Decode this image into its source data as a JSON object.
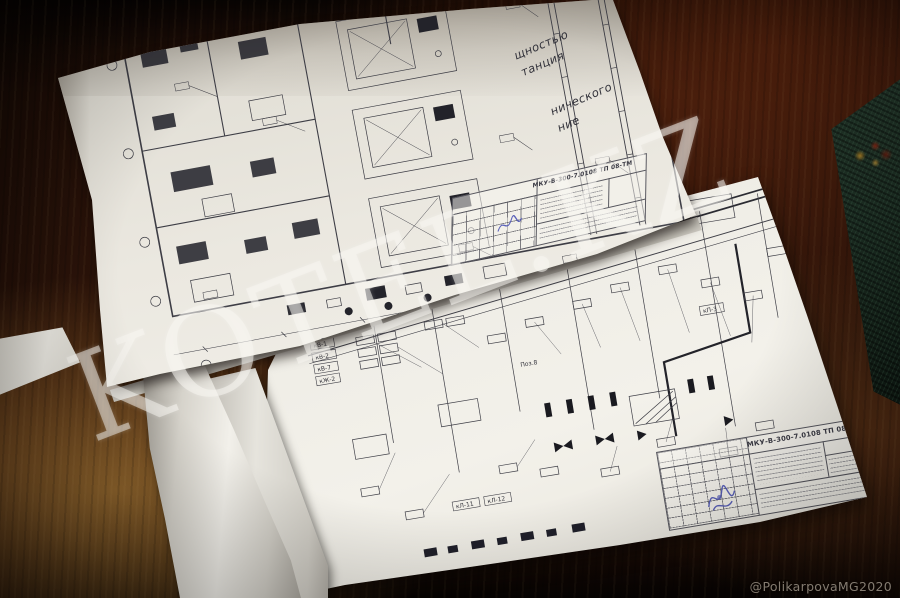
{
  "scene": {
    "watermark": "KOTEL.KZ",
    "credit": "@PolikarpovaMG2020"
  },
  "top_sheet": {
    "notes": {
      "frag1": "щностью",
      "frag2": "танция",
      "frag3": "нического",
      "frag4": "ние"
    },
    "plan": {
      "top_dimension": "17000"
    },
    "title_block": {
      "doc_number": "МКУ-В-300-7.0108 ТП 08-ТМ"
    }
  },
  "bottom_sheet": {
    "title_block": {
      "doc_number": "МКУ-В-300-7.0108 ТП 08-АТМ"
    },
    "tags": {
      "t1": "кВ-1",
      "t2": "кВ-2",
      "t3": "кВ-7",
      "t4": "кЖ-2",
      "t5": "кЛ-11",
      "t6": "кЛ-12",
      "t7": "кП-3",
      "t8": "Поз.8"
    }
  },
  "colors": {
    "table_wood": "#3a1c0e",
    "paper": "#eceae3",
    "book_green": "#1c2b20",
    "ink_blue": "#4a52b4"
  }
}
